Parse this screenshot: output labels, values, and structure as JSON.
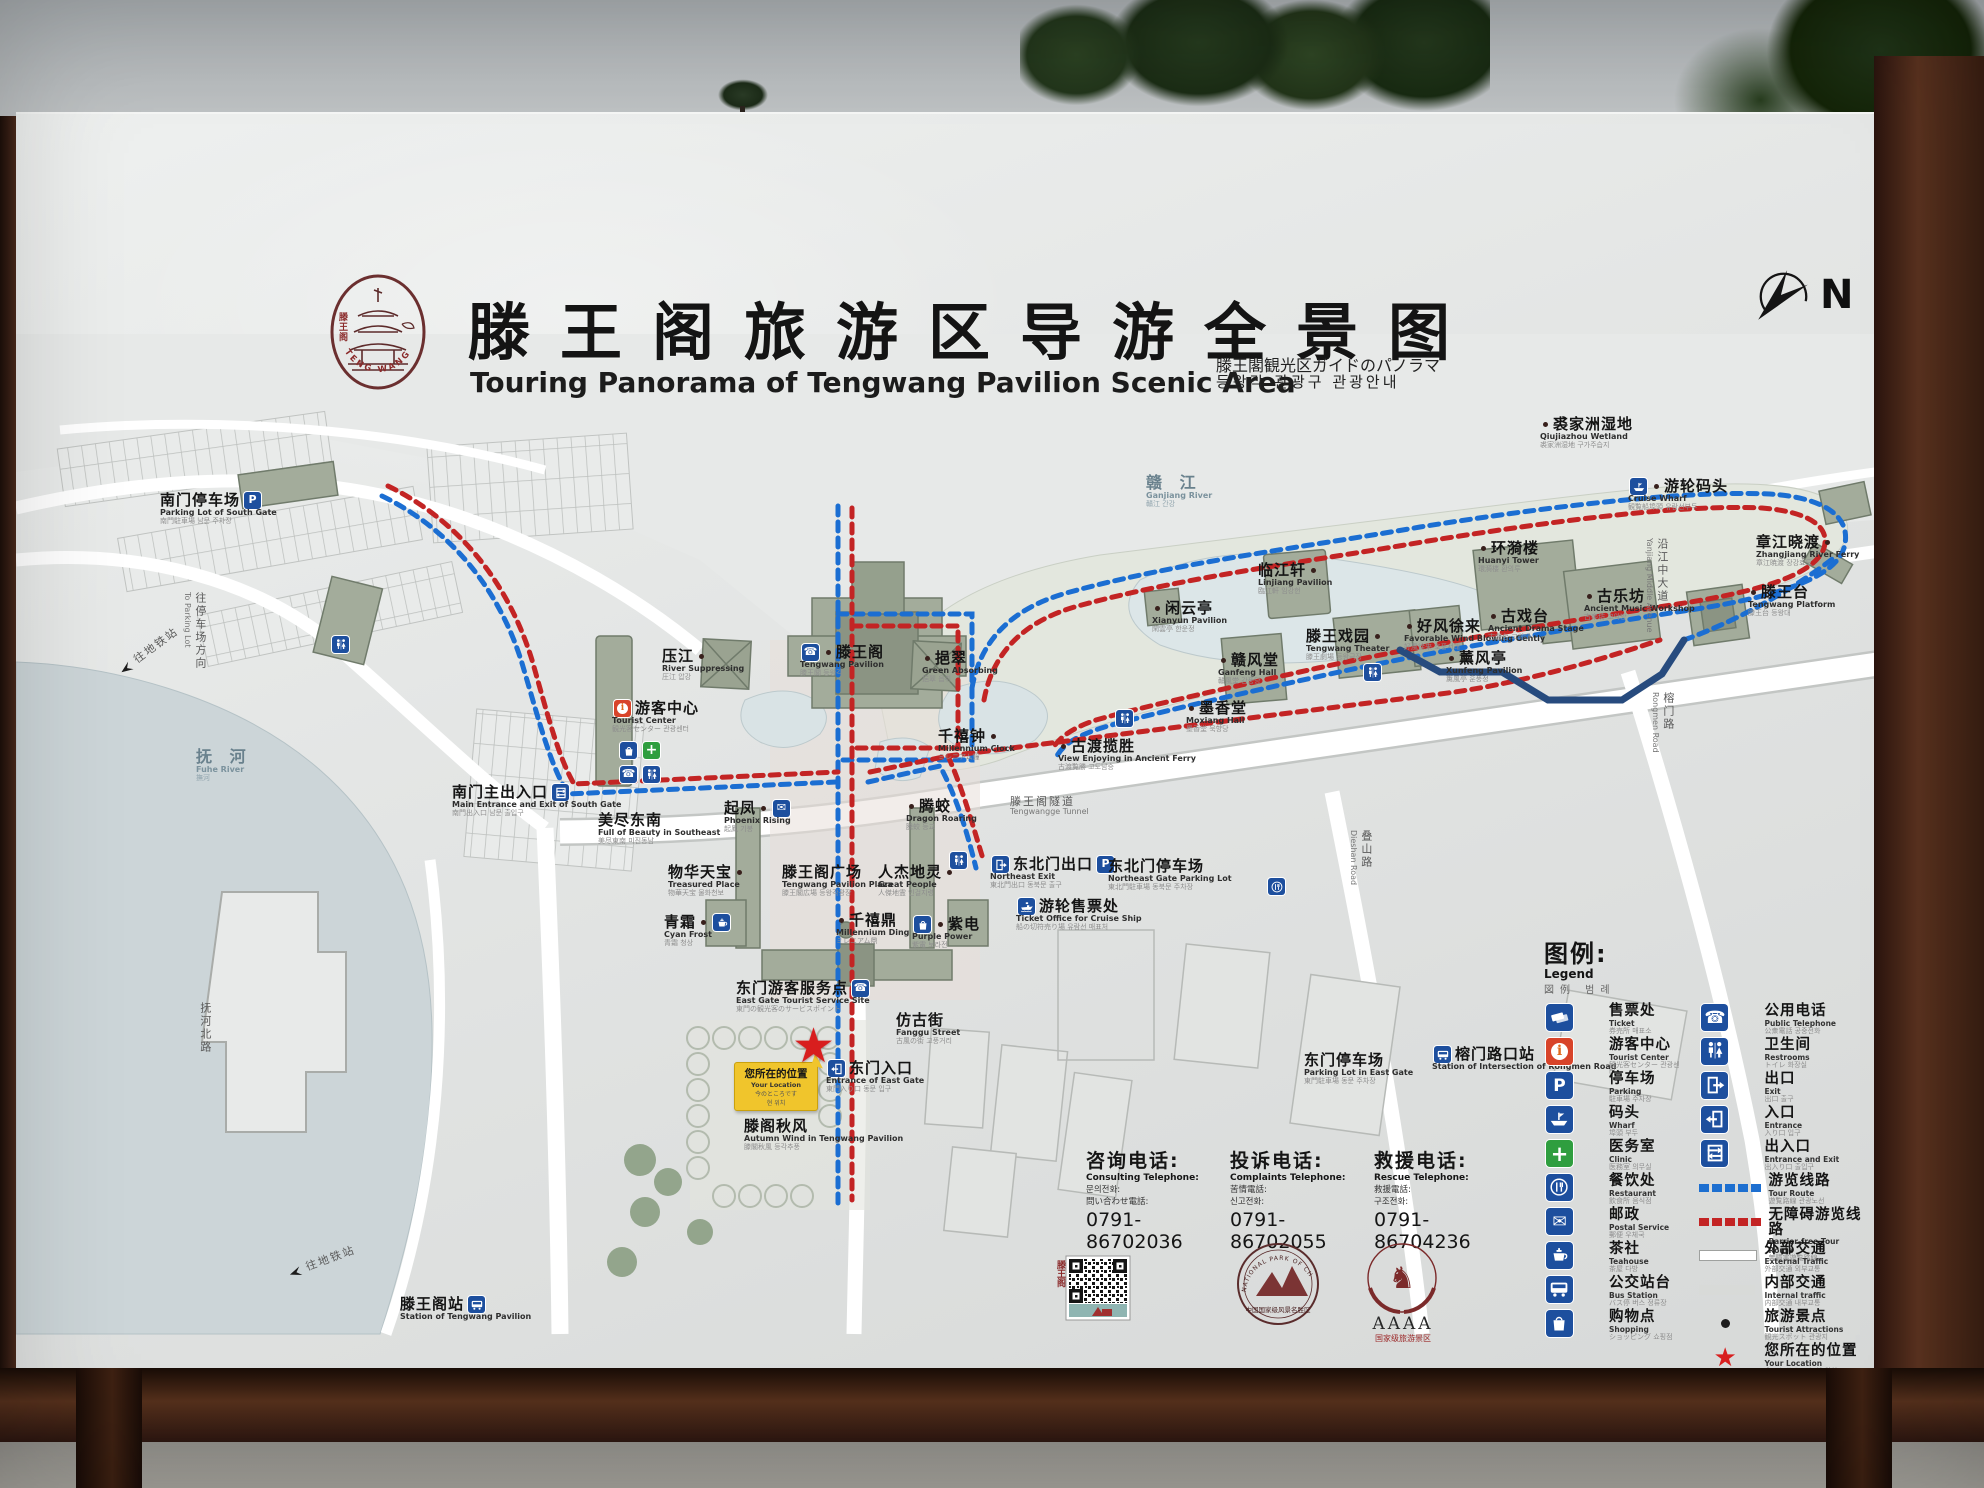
{
  "sign": {
    "title_zh": "滕王阁旅游区导游全景图",
    "title_en": "Touring Panorama of Tengwang Pavilion Scenic Area",
    "title_ja": "滕王閣観光区ガイドのパノラマ",
    "title_ko": "등왕각 관광구 관광안내",
    "north_label": "N",
    "logo_zh": "滕王阁",
    "logo_en": "TENG WANG GE"
  },
  "map": {
    "routes": {
      "tour_route_color": "#1b6ed2",
      "barrier_free_route_color": "#c32424"
    },
    "your_location": {
      "zh": "您所在的位置",
      "en": "Your Location",
      "ja": "今のところです",
      "ko": "현 위치"
    },
    "labels": [
      {
        "n": "south-gate-parking-label",
        "zh": "南门停车场",
        "en": "Parking Lot of South Gate",
        "sub": "南門駐車場 남문 주차장",
        "x": 160,
        "y": 492,
        "post": [
          "parking"
        ]
      },
      {
        "n": "to-parking-direction-label",
        "zh": "往停车场方向",
        "en": "To Parking Lot",
        "x": 182,
        "y": 592,
        "cls": "road vtext"
      },
      {
        "n": "to-metro-upper-label",
        "zh": "往地铁站",
        "x": 112,
        "y": 668,
        "cls": "road",
        "rot": -36,
        "pre": [
          "dirarrow"
        ]
      },
      {
        "n": "fuhe-river-label",
        "zh": "抚 河",
        "en": "Fuhe River",
        "sub": "撫河",
        "x": 196,
        "y": 748,
        "cls": "water"
      },
      {
        "n": "fuhebei-road-label",
        "zh": "抚河北路",
        "x": 196,
        "y": 1002,
        "cls": "road vtext"
      },
      {
        "n": "south-main-entrance-label",
        "zh": "南门主出入口",
        "en": "Main Entrance and Exit of South Gate",
        "sub": "南門出入口 남문 출입구",
        "x": 452,
        "y": 784,
        "post": [
          "entranceexit"
        ]
      },
      {
        "n": "beauty-southeast-label",
        "zh": "美尽东南",
        "en": "Full of Beauty in Southeast",
        "sub": "美尽東南 미진동남",
        "x": 598,
        "y": 812
      },
      {
        "n": "tourist-center-label",
        "zh": "游客中心",
        "en": "Tourist Center",
        "sub": "観光客センター 관광센터",
        "x": 612,
        "y": 700,
        "pre": [
          "touristcenter"
        ]
      },
      {
        "n": "tourist-center-services",
        "x": 618,
        "y": 742,
        "pre": [
          "shopping",
          "firstaid"
        ]
      },
      {
        "n": "tourist-center-services-2",
        "x": 618,
        "y": 766,
        "pre": [
          "phone",
          "restroom"
        ]
      },
      {
        "n": "yajiang-label",
        "zh": "压江",
        "en": "River Suppressing",
        "sub": "圧江 압강",
        "x": 662,
        "y": 648,
        "dot": "r"
      },
      {
        "n": "tengwang-pavilion-label",
        "zh": "滕王阁",
        "en": "Tengwang Pavilion",
        "sub": "滕王閣 등왕각",
        "x": 800,
        "y": 644,
        "pre": [
          "phone"
        ],
        "dot": "l"
      },
      {
        "n": "yicui-label",
        "zh": "挹翠",
        "en": "Green Absorbing",
        "sub": "挹翠 읍취",
        "x": 922,
        "y": 650,
        "dot": "l"
      },
      {
        "n": "millennium-clock-label",
        "zh": "千禧钟",
        "en": "Millennium Clock",
        "sub": "ミレニアム鐘",
        "x": 938,
        "y": 728,
        "dot": "r"
      },
      {
        "n": "qifeng-label",
        "zh": "起凤",
        "en": "Phoenix Rising",
        "sub": "起鳳 기봉",
        "x": 724,
        "y": 800,
        "dot": "r",
        "post": [
          "mail"
        ]
      },
      {
        "n": "tengjiao-label",
        "zh": "腾蛟",
        "en": "Dragon Roaring",
        "sub": "騰蛟 등교",
        "x": 906,
        "y": 798,
        "dot": "l"
      },
      {
        "n": "treasured-place-label",
        "zh": "物华天宝",
        "en": "Treasured Place",
        "sub": "物華天宝 물화천보",
        "x": 668,
        "y": 864,
        "dot": "r"
      },
      {
        "n": "tengwang-plaza-label",
        "zh": "滕王阁广场",
        "en": "Tengwang Pavilion Plaza",
        "sub": "滕王閣広場 등왕각광장",
        "x": 782,
        "y": 864
      },
      {
        "n": "great-people-label",
        "zh": "人杰地灵",
        "en": "Great People",
        "sub": "人傑地霊 인걸지령",
        "x": 878,
        "y": 864,
        "dot": "r"
      },
      {
        "n": "millennium-ding-label",
        "zh": "千禧鼎",
        "en": "Millennium Ding",
        "sub": "ミレニアム鼎",
        "x": 836,
        "y": 912,
        "dot": "l"
      },
      {
        "n": "cyan-frost-label",
        "zh": "青霜",
        "en": "Cyan Frost",
        "sub": "青霜 청상",
        "x": 664,
        "y": 914,
        "dot": "r",
        "post": [
          "teahouse"
        ]
      },
      {
        "n": "purple-power-label",
        "zh": "紫电",
        "en": "Purple Power",
        "sub": "紫電 보라전",
        "x": 912,
        "y": 916,
        "pre": [
          "shopping"
        ],
        "dot": "l"
      },
      {
        "n": "east-gate-service-label",
        "zh": "东门游客服务点",
        "en": "East Gate Tourist Service Site",
        "sub": "東門の観光客のサービスポイント",
        "x": 736,
        "y": 980,
        "post": [
          "phone"
        ]
      },
      {
        "n": "fanggu-street-label",
        "zh": "仿古街",
        "en": "Fanggu Street",
        "sub": "古風の街 고풍거리",
        "x": 896,
        "y": 1012
      },
      {
        "n": "east-gate-entrance-label",
        "zh": "东门入口",
        "en": "Entrance of East Gate",
        "sub": "東門入り口 동문 입구",
        "x": 826,
        "y": 1060,
        "pre": [
          "entrance"
        ]
      },
      {
        "n": "autumn-wind-label",
        "zh": "滕阁秋风",
        "en": "Autumn Wind in Tengwang Pavilion",
        "sub": "滕閣秋風 등각추풍",
        "x": 744,
        "y": 1118
      },
      {
        "n": "east-gate-parking-label",
        "zh": "东门停车场",
        "en": "Parking Lot in East Gate",
        "sub": "東門駐車場 동문 주차장",
        "x": 1304,
        "y": 1052
      },
      {
        "n": "rongmen-station-label",
        "zh": "榕门路口站",
        "en": "Station of Intersection of Rongmen Road",
        "x": 1432,
        "y": 1046,
        "pre": [
          "busstop"
        ]
      },
      {
        "n": "tengwangge-station-label",
        "zh": "滕王阁站",
        "en": "Station of Tengwang Pavilion",
        "x": 400,
        "y": 1296,
        "post": [
          "busstop"
        ]
      },
      {
        "n": "to-metro-lower-label",
        "zh": "往地铁站",
        "x": 282,
        "y": 1268,
        "cls": "road",
        "rot": -20,
        "pre": [
          "dirarrow"
        ]
      },
      {
        "n": "ne-exit-label",
        "zh": "东北门出口",
        "en": "Northeast Exit",
        "sub": "東北門出口 동북문 출구",
        "x": 990,
        "y": 856,
        "pre": [
          "exit"
        ],
        "post": [
          "parking"
        ]
      },
      {
        "n": "ne-parking-label",
        "zh": "东北门停车场",
        "en": "Northeast Gate Parking Lot",
        "sub": "東北門駐車場 동북문 주차장",
        "x": 1108,
        "y": 858
      },
      {
        "n": "cruise-ticket-label",
        "zh": "游轮售票处",
        "en": "Ticket Office for Cruise Ship",
        "sub": "船の切符売り場 유람선 매표처",
        "x": 1016,
        "y": 898,
        "pre": [
          "cruise"
        ]
      },
      {
        "n": "tunnel-label",
        "zh": "滕王阁隧道",
        "en": "Tengwangge Tunnel",
        "x": 1010,
        "y": 796,
        "cls": "road"
      },
      {
        "n": "moxiang-hall-label",
        "zh": "墨香堂",
        "en": "Moxiang Hall",
        "sub": "墨香堂 묵향당",
        "x": 1186,
        "y": 700,
        "dot": "l"
      },
      {
        "n": "ancient-ferry-view-label",
        "zh": "古渡揽胜",
        "en": "View Enjoying in Ancient Ferry",
        "sub": "古渡覧勝 고도남승",
        "x": 1058,
        "y": 738,
        "dot": "l"
      },
      {
        "n": "restroom-chip-1",
        "x": 1114,
        "y": 710,
        "pre": [
          "restroom"
        ]
      },
      {
        "n": "ganjiang-river-label",
        "zh": "赣 江",
        "en": "Ganjiang River",
        "sub": "贛江 간강",
        "x": 1146,
        "y": 474,
        "cls": "water"
      },
      {
        "n": "xianyun-pavilion-label",
        "zh": "闲云亭",
        "en": "Xianyun Pavilion",
        "sub": "閑雲亭 한운정",
        "x": 1152,
        "y": 600,
        "dot": "l"
      },
      {
        "n": "linjiang-pavilion-label",
        "zh": "临江轩",
        "en": "Linjiang Pavilion",
        "sub": "臨江軒 임강헌",
        "x": 1258,
        "y": 562,
        "dot": "r"
      },
      {
        "n": "ganfeng-hall-label",
        "zh": "赣风堂",
        "en": "Ganfeng Hall",
        "sub": "贛風堂 감풍당",
        "x": 1218,
        "y": 652,
        "dot": "l"
      },
      {
        "n": "tengwang-theater-label",
        "zh": "滕王戏园",
        "en": "Tengwang Theater",
        "sub": "滕王劇場 등왕극장",
        "x": 1306,
        "y": 628,
        "dot": "r"
      },
      {
        "n": "favorable-wind-label",
        "zh": "好风徐来",
        "en": "Favorable Wind Blowing Gently",
        "sub": "好風徐来 호풍서래",
        "x": 1404,
        "y": 618,
        "dot": "l"
      },
      {
        "n": "huanyi-tower-label",
        "zh": "环漪楼",
        "en": "Huanyi Tower",
        "sub": "環漪楼 환의루",
        "x": 1478,
        "y": 540,
        "dot": "l"
      },
      {
        "n": "ancient-stage-label",
        "zh": "古戏台",
        "en": "Ancient Drama Stage",
        "sub": "古戯台 고희대",
        "x": 1488,
        "y": 608,
        "dot": "l"
      },
      {
        "n": "xunfeng-pavilion-label",
        "zh": "薰风亭",
        "en": "Xunfeng Pavilion",
        "sub": "薫風亭 훈풍정",
        "x": 1446,
        "y": 650,
        "dot": "l"
      },
      {
        "n": "music-workshop-label",
        "zh": "古乐坊",
        "en": "Ancient Music Workshop",
        "sub": "古楽坊 고악방",
        "x": 1584,
        "y": 588,
        "dot": "l"
      },
      {
        "n": "tengwang-terrace-label",
        "zh": "滕王台",
        "en": "Tengwang Platform",
        "sub": "滕王台 등왕대",
        "x": 1748,
        "y": 584,
        "dot": "l"
      },
      {
        "n": "zhangjiang-ferry-label",
        "zh": "章江晓渡",
        "en": "Zhangjiang River Ferry",
        "sub": "章江暁渡 장강효도",
        "x": 1756,
        "y": 534,
        "dot": "r"
      },
      {
        "n": "cruise-wharf-label",
        "zh": "游轮码头",
        "en": "Cruise Wharf",
        "sub": "観覧船埠頭 유람선부두",
        "x": 1628,
        "y": 478,
        "pre": [
          "wharf"
        ],
        "dot": "l"
      },
      {
        "n": "qiujiazhou-wetland-label",
        "zh": "裘家洲湿地",
        "en": "Qiujiazhou Wetland",
        "sub": "裘家洲湿地 구가주습지",
        "x": 1540,
        "y": 416,
        "dot": "l"
      },
      {
        "n": "yanjiang-avenue-label",
        "zh": "沿江中大道",
        "en": "Yanjiang Middle Avenue",
        "x": 1644,
        "y": 538,
        "cls": "road vtext"
      },
      {
        "n": "dieshan-road-label",
        "zh": "叠山路",
        "en": "Dieshan Road",
        "x": 1348,
        "y": 830,
        "cls": "road vtext"
      },
      {
        "n": "rongmen-road-label",
        "zh": "榕门路",
        "en": "Rongmen Road",
        "x": 1650,
        "y": 692,
        "cls": "road vtext"
      },
      {
        "n": "restaurant-chip",
        "x": 1266,
        "y": 878,
        "pre": [
          "restaurant"
        ]
      },
      {
        "n": "restroom-chip-2",
        "x": 1362,
        "y": 664,
        "pre": [
          "restroom"
        ]
      },
      {
        "n": "restroom-chip-3",
        "x": 948,
        "y": 852,
        "pre": [
          "restroom"
        ]
      },
      {
        "n": "restroom-chip-4",
        "x": 330,
        "y": 636,
        "pre": [
          "restroom"
        ]
      }
    ]
  },
  "legend": {
    "title_zh": "图例:",
    "title_en": "Legend",
    "title_sub": "図例 범례",
    "left": [
      {
        "zh": "售票处",
        "en": "Ticket",
        "sub": "券売所 매표소",
        "icon": "ticket"
      },
      {
        "zh": "游客中心",
        "en": "Tourist Center",
        "sub": "観光客センター 관광센터",
        "icon": "touristcenter"
      },
      {
        "zh": "停车场",
        "en": "Parking",
        "sub": "駐車場 주차장",
        "icon": "parking"
      },
      {
        "zh": "码头",
        "en": "Wharf",
        "sub": "埠頭 부두",
        "icon": "wharf"
      },
      {
        "zh": "医务室",
        "en": "Clinic",
        "sub": "医務室 의무실",
        "icon": "firstaid"
      },
      {
        "zh": "餐饮处",
        "en": "Restaurant",
        "sub": "飲食所 음식점",
        "icon": "restaurant"
      },
      {
        "zh": "邮政",
        "en": "Postal Service",
        "sub": "郵便 우체국",
        "icon": "mail"
      },
      {
        "zh": "茶社",
        "en": "Teahouse",
        "sub": "茶屋 다방",
        "icon": "teahouse"
      },
      {
        "zh": "公交站台",
        "en": "Bus Station",
        "sub": "バス停 버스 정류장",
        "icon": "busstop"
      },
      {
        "zh": "购物点",
        "en": "Shopping",
        "sub": "ショッピング 쇼핑점",
        "icon": "shopping"
      }
    ],
    "right": [
      {
        "zh": "公用电话",
        "en": "Public Telephone",
        "sub": "公衆電話 공중전화",
        "icon": "phone"
      },
      {
        "zh": "卫生间",
        "en": "Restrooms",
        "sub": "トイレ 화장실",
        "icon": "restroom"
      },
      {
        "zh": "出口",
        "en": "Exit",
        "sub": "出口 출구",
        "icon": "exit"
      },
      {
        "zh": "入口",
        "en": "Entrance",
        "sub": "入り口 입구",
        "icon": "entrance"
      },
      {
        "zh": "出入口",
        "en": "Entrance and Exit",
        "sub": "出入り口 출입구",
        "icon": "entranceexit"
      },
      {
        "zh": "游览线路",
        "en": "Tour Route",
        "sub": "遊覧路線 관광노선",
        "swatch": "route-blue"
      },
      {
        "zh": "无障碍游览线路",
        "en": "Barrier-free Tour Route",
        "sub": "無障害遊覧路線",
        "swatch": "route-red"
      },
      {
        "zh": "外部交通",
        "en": "External Traffic",
        "sub": "外部交通 외부교통",
        "swatch": "road-ext"
      },
      {
        "zh": "内部交通",
        "en": "Internal traffic",
        "sub": "内部交通 내부교통",
        "swatch": "road-int"
      },
      {
        "zh": "旅游景点",
        "en": "Tourist Attractions",
        "sub": "観光スポット 관광지",
        "swatch": "poi-dot"
      },
      {
        "zh": "您所在的位置",
        "en": "Your Location",
        "sub": "今のところです 현 위치",
        "swatch": "star"
      }
    ]
  },
  "phones": [
    {
      "zh": "咨询电话:",
      "en": "Consulting Telephone:",
      "l3": "문의전화:",
      "l4": "問い合わせ電話:",
      "num": "0791-86702036"
    },
    {
      "zh": "投诉电话:",
      "en": "Complaints Telephone:",
      "l3": "苦情電話:",
      "l4": "신고전화:",
      "num": "0791-86702055"
    },
    {
      "zh": "救援电话:",
      "en": "Rescue Telephone:",
      "l3": "救援電話:",
      "l4": "구조전화:",
      "num": "0791-86704236"
    }
  ],
  "badges": {
    "qr_caption": "滕王阁",
    "park_seal_en": "NATIONAL PARK OF CHINA",
    "park_seal_zh": "中国国家级风景名胜区",
    "grade": "AAAA",
    "grade_caption": "国家级旅游景区"
  }
}
